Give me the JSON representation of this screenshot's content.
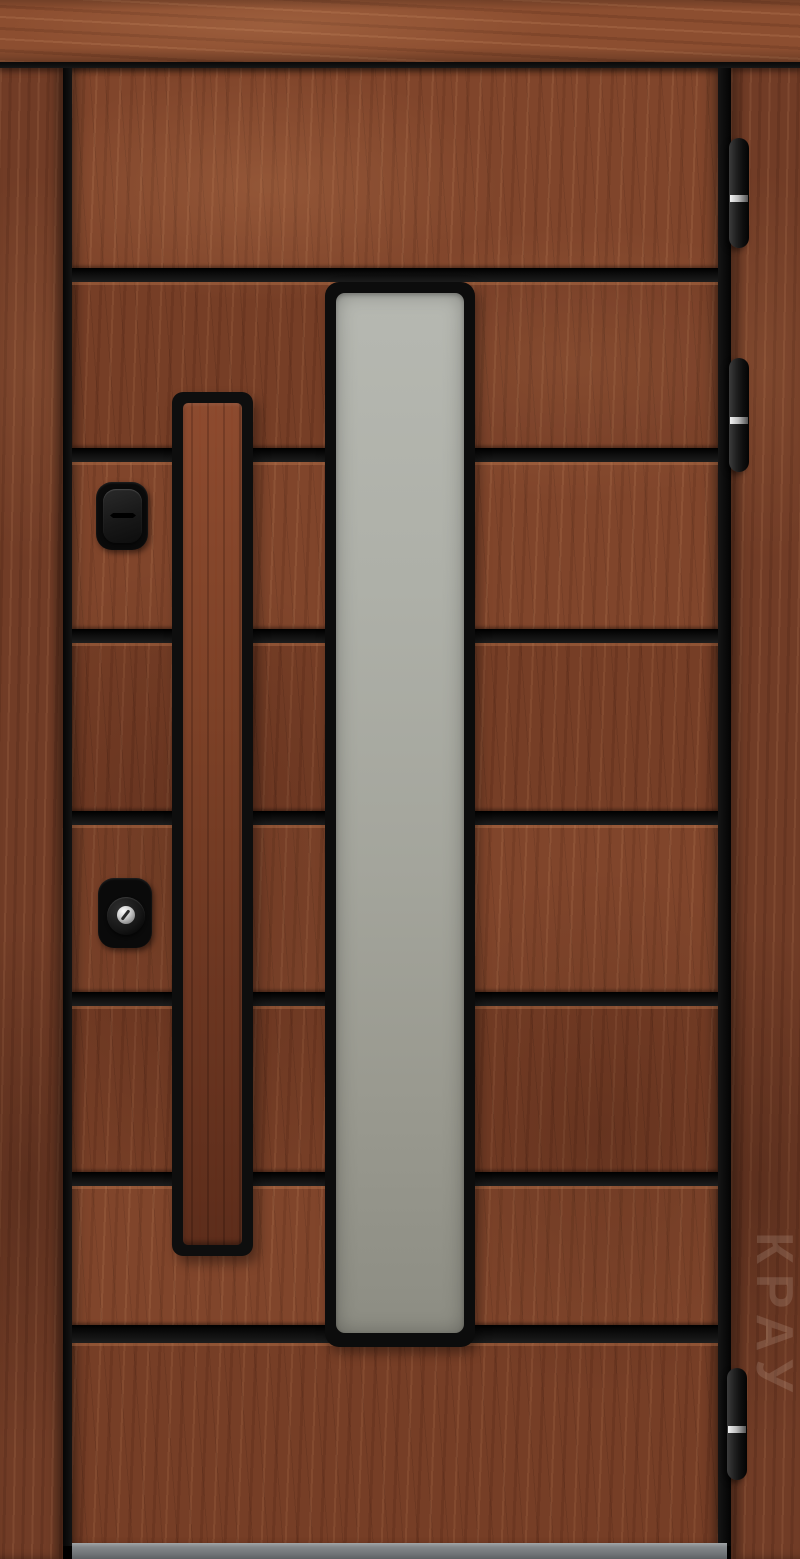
{
  "image": {
    "kind": "product-photo",
    "subject": "modern wooden entry door with vertical frosted glass insert",
    "width": 800,
    "height": 1559
  },
  "door": {
    "watermark_text": "КРАУ",
    "colors": {
      "leaf_wood": "#7c4128",
      "frame_wood": "#713c26",
      "header_wood": "#8c4e30",
      "groove_black": "#0e0e0e",
      "glass_top": "#b6b8b1",
      "glass_bottom": "#8d8d83",
      "hardware_black": "#0a0a0a",
      "hinge_band_silver": "#bdbdbd",
      "threshold_gray": "#83878a"
    },
    "grooves": [
      {
        "y": 268,
        "h": 14
      },
      {
        "y": 448,
        "h": 14
      },
      {
        "y": 629,
        "h": 14
      },
      {
        "y": 811,
        "h": 14
      },
      {
        "y": 992,
        "h": 14
      },
      {
        "y": 1172,
        "h": 14
      },
      {
        "y": 1325,
        "h": 18
      }
    ],
    "panel_rows": [
      {
        "y": 68,
        "h": 200,
        "tone": "b"
      },
      {
        "y": 282,
        "h": 166,
        "tone": "a"
      },
      {
        "y": 462,
        "h": 167,
        "tone": "b"
      },
      {
        "y": 643,
        "h": 168,
        "tone": "a"
      },
      {
        "y": 825,
        "h": 167,
        "tone": "b"
      },
      {
        "y": 1006,
        "h": 166,
        "tone": "a"
      },
      {
        "y": 1186,
        "h": 139,
        "tone": "b"
      },
      {
        "y": 1343,
        "h": 200,
        "tone": "a"
      }
    ],
    "hinges": [
      {
        "x": 729,
        "y": 138,
        "h": 110
      },
      {
        "x": 729,
        "y": 358,
        "h": 114
      },
      {
        "x": 727,
        "y": 1368,
        "h": 112
      }
    ],
    "glass": {
      "frame": {
        "x": 325,
        "y": 282,
        "w": 150,
        "h": 1065
      },
      "pane": {
        "x": 336,
        "y": 293,
        "w": 128,
        "h": 1040
      }
    },
    "handle": {
      "frame": {
        "x": 172,
        "y": 392,
        "w": 81,
        "h": 864
      },
      "wood": {
        "x": 183,
        "y": 403,
        "w": 59,
        "h": 842
      }
    },
    "locks": {
      "thumbturn": {
        "x": 96,
        "y": 482,
        "w": 52,
        "h": 68
      },
      "cylinder": {
        "x": 98,
        "y": 878,
        "w": 54,
        "h": 70
      }
    },
    "threshold": {
      "x": 72,
      "y": 1543,
      "w": 655,
      "h": 16
    }
  }
}
